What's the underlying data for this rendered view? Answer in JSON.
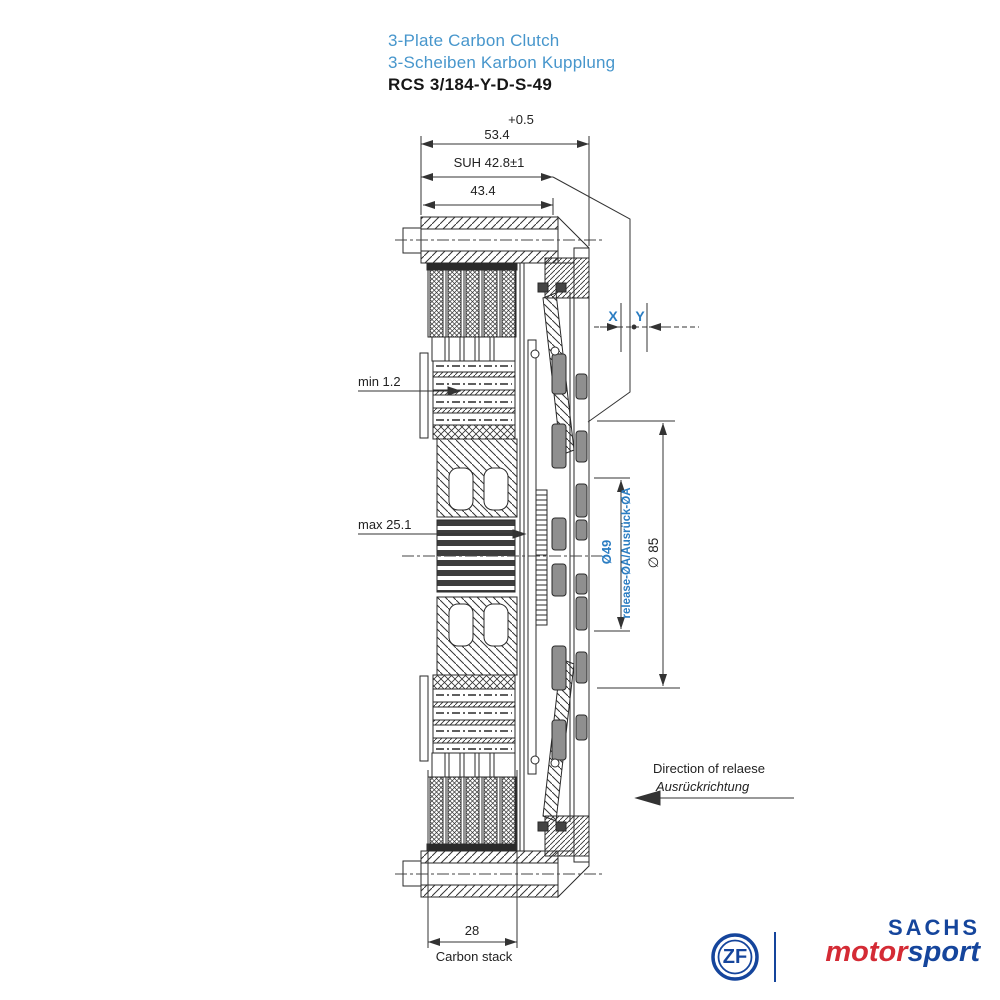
{
  "title": {
    "line1": "3-Plate Carbon Clutch",
    "line2": "3-Scheiben Karbon Kupplung",
    "part_number": "RCS 3/184-Y-D-S-49"
  },
  "dimensions": {
    "tolerance": "+0.5",
    "overall_depth": "53.4",
    "suh": "SUH 42.8±1",
    "cover_depth": "43.4",
    "min_wear": "min 1.2",
    "max_stack": "max 25.1",
    "x_label": "X",
    "y_label": "Y",
    "release_dia": "Ø49",
    "release_label": "release-ØA/Ausrück-ØA",
    "outer_dia": "∅ 85",
    "stack_width": "28",
    "stack_caption": "Carbon stack"
  },
  "release_direction": {
    "line_en": "Direction of relaese",
    "line_de": "Ausrückrichtung"
  },
  "logo": {
    "zf": "ZF",
    "sachs": "SACHS",
    "motor": "motor",
    "sport": "sport"
  },
  "colors": {
    "title_blue": "#4796cc",
    "dimension_blue": "#2b7dc2",
    "logo_blue": "#15459c",
    "logo_red": "#d42b35",
    "line_color": "#2a2a2a"
  }
}
